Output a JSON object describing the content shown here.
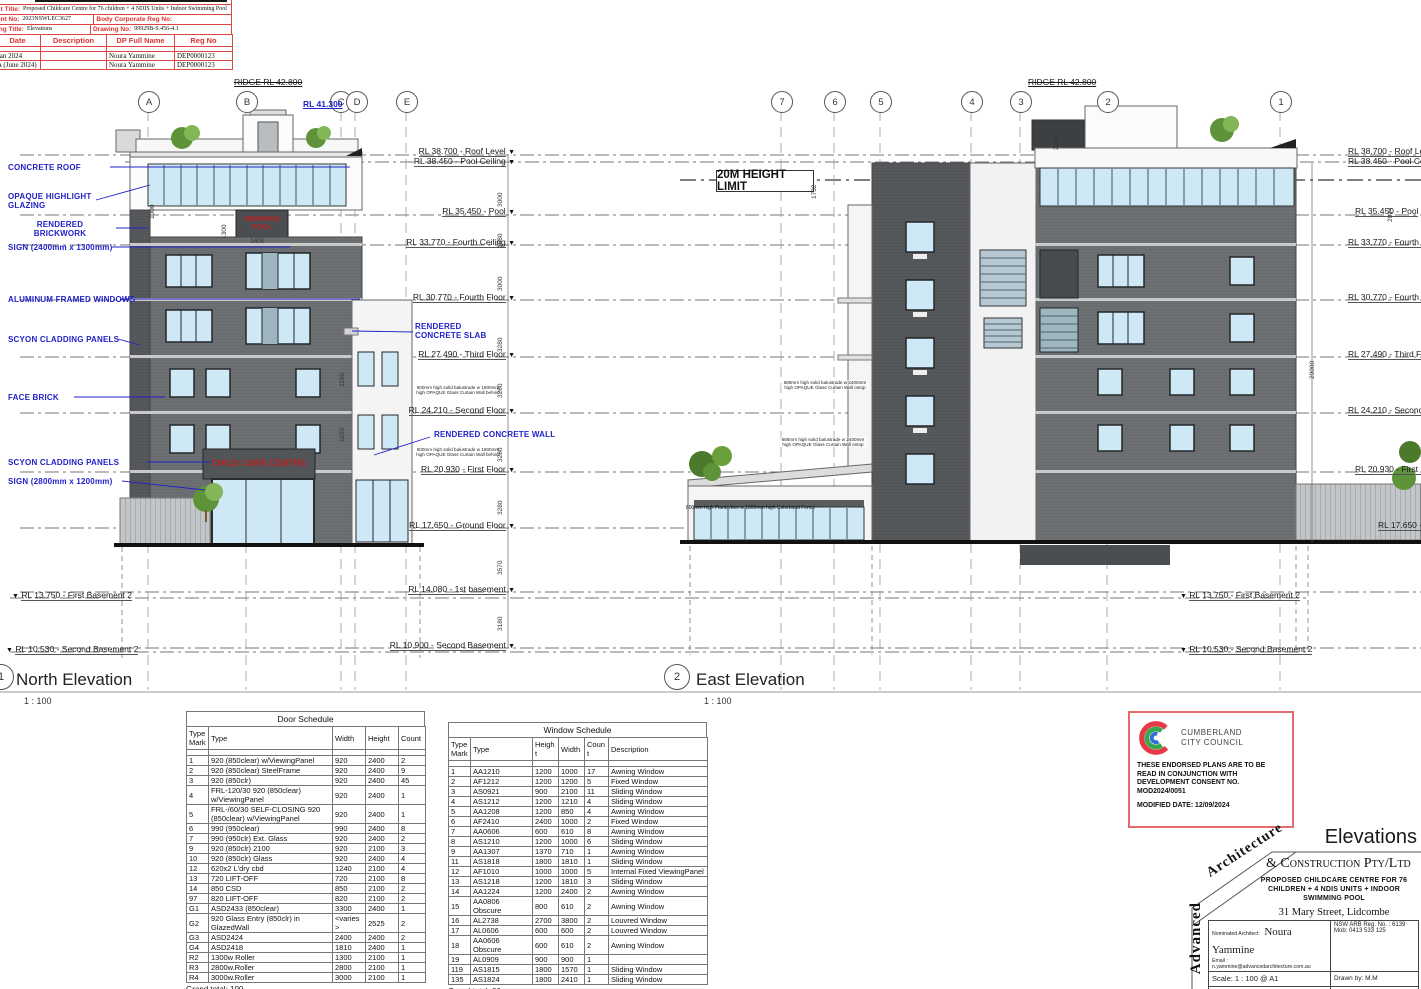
{
  "revision_block": {
    "title_label": "ct Title:",
    "title_value": "Proposed Childcare Centre for 76 children + 4 NDIS Units + Indoor Swimming Pool",
    "matter_label": "ent No:",
    "matter_value": "2023NSWLEC3627",
    "body_corp_label": "Body Corporate Reg No:",
    "drawing_title_label": "ing Title:",
    "drawing_title_value": "Elevations",
    "drawing_no_label": "Drawing No:",
    "drawing_no_value": "99929B-S.456-4.1",
    "table": {
      "headers": [
        "Date",
        "Description",
        "DP Full Name",
        "Reg No"
      ],
      "rows": [
        [
          "Jan 2024",
          "",
          "Noura Yammine",
          "DEP0000123"
        ],
        [
          "A (June 2024)",
          "",
          "Noura Yammine",
          "DEP0000123"
        ]
      ]
    }
  },
  "grid": {
    "north": [
      "A",
      "B",
      "C",
      "D",
      "E"
    ],
    "east": [
      "7",
      "6",
      "5",
      "4",
      "3",
      "2",
      "1"
    ]
  },
  "ridge": {
    "north": "RIDGE RL 42.800",
    "north_blue": "RL 41.300",
    "east": "RIDGE RL 42.800"
  },
  "height_limit_label": "20M HEIGHT LIMIT",
  "levels": {
    "north": [
      "RL 38.700 - Roof Level",
      "RL 38.450 - Pool Ceiling",
      "RL 35.450 - Pool",
      "RL 33.770 - Fourth Ceiling",
      "RL 30.770 - Fourth Floor",
      "RL 27.490 - Third Floor",
      "RL 24.210 - Second Floor",
      "RL 20.930 - First Floor",
      "RL 17.650 - Ground Floor",
      "RL 14.080 - 1st basement",
      "RL 10.900 - Second Basement"
    ],
    "east": [
      "RL 38.700 - Roof Level",
      "RL 38.450 - Pool Ceiling",
      "RL 35.450 - Pool",
      "RL 33.770 - Fourth Ceiling",
      "RL 30.770 - Fourth Floor",
      "RL 27.490 - Third Floor",
      "RL 24.210 - Second Floor",
      "RL 20.930 - First Floor",
      "RL 17.650 - Ground Floor"
    ],
    "basement2": [
      "RL 13.750 - First Basement 2",
      "RL 10.530 - Second Basement 2"
    ]
  },
  "annotations": {
    "north": [
      "CONCRETE ROOF",
      "OPAQUE HIGHLIGHT GLAZING",
      "RENDERED BRICKWORK",
      "SIGN (2400mm x 1300mm)",
      "ALUMINUM FRAMED WINDOWS",
      "SCYON CLADDING PANELS",
      "FACE BRICK",
      "SCYON CLADDING  PANELS",
      "SIGN (2800mm x 1200mm)"
    ],
    "rendered_concrete_slab": "RENDERED CONCRETE SLAB",
    "rendered_concrete_wall": "RENDERED CONCRETE WALL",
    "balustrade_north": "600mm high solid balustrade w 1800mm high OPAQUE Glass Curtain Wall behind",
    "balustrade_east": "688mm high solid balustrade w 2400mm high OPAQUE Glass Curtain Wall ontop",
    "planter_east": "600mm high Planterbox w 1800mm high Colorbond Fence"
  },
  "signs": {
    "pool": "SWIMMING POOL",
    "childcare": "CHILD CARE CENTRE"
  },
  "dims": {
    "north": [
      "3000",
      "1680",
      "3000",
      "3280",
      "3280",
      "3280",
      "3280",
      "3570",
      "3180"
    ],
    "north_top": [
      "1000",
      "1300",
      "2400"
    ],
    "north_openings": [
      "1150",
      "1150"
    ],
    "east": [
      "2400",
      "1732",
      "2014",
      "20000"
    ]
  },
  "views": [
    {
      "num": "1",
      "title": "North Elevation",
      "scale": "1 : 100"
    },
    {
      "num": "2",
      "title": "East Elevation",
      "scale": "1 : 100"
    }
  ],
  "door_schedule": {
    "title": "Door Schedule",
    "headers": [
      "Type Mark",
      "Type",
      "Width",
      "Height",
      "Count"
    ],
    "rows": [
      [
        "1",
        "920 (850clear) w/ViewingPanel",
        "920",
        "2400",
        "2"
      ],
      [
        "2",
        "920 (850clear) SteelFrame",
        "920",
        "2400",
        "9"
      ],
      [
        "3",
        "920 (850clr)",
        "920",
        "2400",
        "45"
      ],
      [
        "4",
        "FRL-120/30 920 (850clear) w/ViewingPanel",
        "920",
        "2400",
        "1"
      ],
      [
        "5",
        "FRL-/60/30 SELF-CLOSING 920 (850clear) w/ViewingPanel",
        "920",
        "2400",
        "1"
      ],
      [
        "6",
        "990 (950clear)",
        "990",
        "2400",
        "8"
      ],
      [
        "7",
        "990 (950clr) Ext. Glass",
        "920",
        "2400",
        "2"
      ],
      [
        "9",
        "920 (850clr) 2100",
        "920",
        "2100",
        "3"
      ],
      [
        "10",
        "920 (850clr) Glass",
        "920",
        "2400",
        "4"
      ],
      [
        "12",
        "620x2 L'dry cbd",
        "1240",
        "2100",
        "4"
      ],
      [
        "13",
        "720 LIFT-OFF",
        "720",
        "2100",
        "8"
      ],
      [
        "14",
        "850 CSD",
        "850",
        "2100",
        "2"
      ],
      [
        "97",
        "820 LIFT-OFF",
        "820",
        "2100",
        "2"
      ],
      [
        "G1",
        "ASD2433 (850clear)",
        "3300",
        "2400",
        "1"
      ],
      [
        "G2",
        "920 Glass Entry (850clr) in GlazedWall",
        "<varies>",
        "2525",
        "2"
      ],
      [
        "G3",
        "ASD2424",
        "2400",
        "2400",
        "2"
      ],
      [
        "G4",
        "ASD2418",
        "1810",
        "2400",
        "1"
      ],
      [
        "R2",
        "1300w Roller",
        "1300",
        "2100",
        "1"
      ],
      [
        "R3",
        "2800w.Roller",
        "2800",
        "2100",
        "1"
      ],
      [
        "R4",
        "3000w.Roller",
        "3000",
        "2100",
        "1"
      ]
    ],
    "footer": "Grand total: 100"
  },
  "window_schedule": {
    "title": "Window Schedule",
    "headers": [
      "Type Mark",
      "Type",
      "Height",
      "Width",
      "Count",
      "Description"
    ],
    "rows": [
      [
        "1",
        "AA1210",
        "1200",
        "1000",
        "17",
        "Awning Window"
      ],
      [
        "2",
        "AF1212",
        "1200",
        "1200",
        "5",
        "Fixed Window"
      ],
      [
        "3",
        "AS0921",
        "900",
        "2100",
        "11",
        "Sliding Window"
      ],
      [
        "4",
        "AS1212",
        "1200",
        "1210",
        "4",
        "Sliding Window"
      ],
      [
        "5",
        "AA1208",
        "1200",
        "850",
        "4",
        "Awning Window"
      ],
      [
        "6",
        "AF2410",
        "2400",
        "1000",
        "2",
        "Fixed Window"
      ],
      [
        "7",
        "AA0606",
        "600",
        "610",
        "8",
        "Awning Window"
      ],
      [
        "8",
        "AS1210",
        "1200",
        "1000",
        "6",
        "Sliding Window"
      ],
      [
        "9",
        "AA1307",
        "1370",
        "710",
        "1",
        "Awning Window"
      ],
      [
        "11",
        "AS1818",
        "1800",
        "1810",
        "1",
        "Sliding Window"
      ],
      [
        "12",
        "AF1010",
        "1000",
        "1000",
        "5",
        "Internal Fixed ViewingPanel"
      ],
      [
        "13",
        "AS1218",
        "1200",
        "1810",
        "3",
        "Sliding Window"
      ],
      [
        "14",
        "AA1224",
        "1200",
        "2400",
        "2",
        "Awning Window"
      ],
      [
        "15",
        "AA0806 Obscure",
        "800",
        "610",
        "2",
        "Awning Window"
      ],
      [
        "16",
        "AL2738",
        "2700",
        "3800",
        "2",
        "Louvred Window"
      ],
      [
        "17",
        "AL0606",
        "600",
        "600",
        "2",
        "Louvred Window"
      ],
      [
        "18",
        "AA0606 Obscure",
        "600",
        "610",
        "2",
        "Awning Window"
      ],
      [
        "19",
        "AL0909",
        "900",
        "900",
        "1",
        ""
      ],
      [
        "119",
        "AS1815",
        "1800",
        "1570",
        "1",
        "Sliding Window"
      ],
      [
        "135",
        "AS1824",
        "1800",
        "2410",
        "1",
        "Sliding Window"
      ]
    ],
    "footer": "Grand total: 80"
  },
  "council_stamp": {
    "org_line1": "CUMBERLAND",
    "org_line2": "CITY COUNCIL",
    "body": "THESE ENDORSED PLANS ARE TO BE READ IN CONJUNCTION WITH DEVELOPMENT CONSENT NO. MOD2024/0051",
    "modified": "MODIFIED DATE: 12/09/2024"
  },
  "title_block": {
    "sheet_title": "Elevations",
    "firm_vertical": "Advanced",
    "firm_script": "Architecture",
    "firm_rest": "&  Construction Pty/Ltd",
    "project": "Proposed Childcare Centre for 76 children + 4 NDIS Units + Indoor Swimming Pool",
    "address": "31 Mary Street, Lidcombe",
    "architect_label": "Nominated Architect:",
    "architect_name": "Noura Yammine",
    "email": "Email : n.yammine@advancedarchitecture.com.au",
    "reg_no": "NSW ARB Reg. No. : 6139",
    "mobile": "Mob:  0413 533 125",
    "scale": "Scale:   1 : 100 @ A1",
    "drawn_by": "Drawn by:  M.M",
    "date": "Date:   Jan 2024",
    "rev": "Rev:  A (June 2024)",
    "note": "Figured dimensions to be taken in",
    "drawing_no_label": "Drawing No:"
  }
}
